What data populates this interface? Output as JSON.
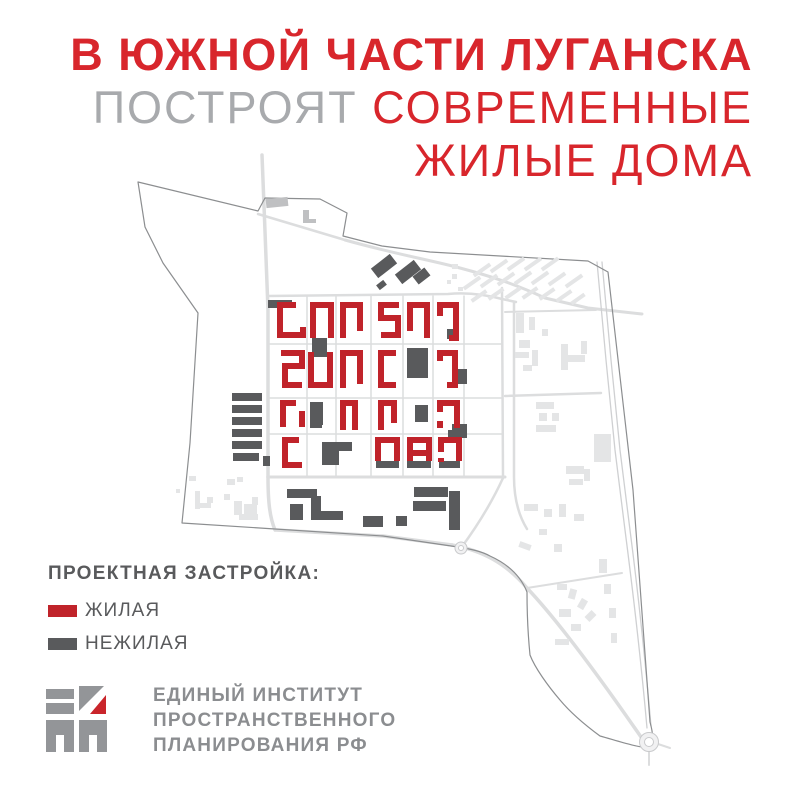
{
  "title": {
    "line1": "В ЮЖНОЙ ЧАСТИ ЛУГАНСКА",
    "line2_gray": "ПОСТРОЯТ",
    "line2_red": "СОВРЕМЕННЫЕ",
    "line3": "ЖИЛЫЕ ДОМА"
  },
  "legend": {
    "heading": "ПРОЕКТНАЯ ЗАСТРОЙКА:",
    "items": [
      {
        "label": "ЖИЛАЯ",
        "color_key": "red-building"
      },
      {
        "label": "НЕЖИЛАЯ",
        "color_key": "dark-building"
      }
    ]
  },
  "logo": {
    "line1": "ЕДИНЫЙ ИНСТИТУТ",
    "line2": "ПРОСТРАНСТВЕННОГО",
    "line3": "ПЛАНИРОВАНИЯ РФ"
  },
  "colors": {
    "title_red": "#d8262c",
    "title_gray": "#a8aaad",
    "text_gray": "#595a5c",
    "logo_gray": "#8b8d90",
    "logo_mark_gray": "#939598",
    "logo_mark_red": "#c9252b",
    "red_building": "#c0232a",
    "dark_building": "#595a5c",
    "medium_building": "#bfc0c2",
    "light_building": "#e4e5e6",
    "road": "#dcddde",
    "rail": "#cfd0d2",
    "boundary": "#8c8e90",
    "roundabout_fill": "#f1f1f2",
    "roundabout_stroke": "#c9cacc"
  },
  "map": {
    "boundary": "M138,182 L258,211 L265,198 L320,199 L347,213 L343,236 L382,246 L430,252 L588,261 L608,272 L633,490 L650,722 C653,733 654,741 650,748 C635,747 618,741 600,736 C585,725 570,712 560,700 C548,686 535,668 530,655 C528,635 527,610 527,592 C521,577 510,565 490,556 C481,551 470,549 458,547 L383,536 L275,529 L182,523 L190,443 L198,313 L163,263 L145,227 Z",
    "roads": [
      {
        "d": "M262,155 C264,210 266,250 268,310 L268,477",
        "w": 3.5
      },
      {
        "d": "M268,477 C268,503 270,518 275,530",
        "w": 3.5
      },
      {
        "d": "M258,214 L345,240",
        "w": 2.5
      },
      {
        "d": "M345,240 C395,254 430,260 460,268 C490,276 515,284 545,298 L588,308 L642,314",
        "w": 3
      },
      {
        "d": "M268,296 L448,294 C468,292 487,295 502,299 L516,302",
        "w": 2.5
      },
      {
        "d": "M268,477 L505,477",
        "w": 3
      },
      {
        "d": "M502,288 L503,477",
        "w": 2.5
      },
      {
        "d": "M514,302 L514,477 C514,500 519,516 527,529",
        "w": 2.5
      },
      {
        "d": "M505,396 L601,393",
        "w": 2.5
      },
      {
        "d": "M505,312 L596,310",
        "w": 2
      },
      {
        "d": "M307,296 L307,477",
        "w": 1.5
      },
      {
        "d": "M336,296 L336,477",
        "w": 1.5
      },
      {
        "d": "M371,296 L371,477",
        "w": 1.5
      },
      {
        "d": "M403,296 L403,477",
        "w": 1.5
      },
      {
        "d": "M433,296 L433,477",
        "w": 1.5
      },
      {
        "d": "M464,296 L464,477",
        "w": 1.5
      },
      {
        "d": "M268,344 L502,344",
        "w": 1.5
      },
      {
        "d": "M268,398 L502,398",
        "w": 1.5
      },
      {
        "d": "M268,434 L502,434",
        "w": 1.5
      },
      {
        "d": "M276,530 L383,536 L452,545",
        "w": 3.5
      },
      {
        "d": "M452,545 C480,550 505,562 527,588 C562,625 605,685 641,737",
        "w": 3.5
      },
      {
        "d": "M461,548 C478,525 492,502 503,478",
        "w": 2.5
      },
      {
        "d": "M527,588 L622,573",
        "w": 2
      },
      {
        "d": "M649,751 L649,765",
        "w": 2
      },
      {
        "d": "M658,744 L670,748",
        "w": 2
      },
      {
        "d": "M597,262 L606,360 L615,450 L625,530 C633,592 641,660 647,728",
        "w": 1.3,
        "rail": true
      },
      {
        "d": "M602,262 L611,360 L620,450 L630,530 C638,592 645,658 651,726",
        "w": 1.3,
        "rail": true
      }
    ],
    "light_buildings": [
      [
        472,
        268,
        20,
        4,
        -35
      ],
      [
        489,
        264,
        20,
        4,
        -35
      ],
      [
        506,
        262,
        20,
        4,
        -35
      ],
      [
        523,
        262,
        20,
        4,
        -35
      ],
      [
        540,
        262,
        20,
        4,
        -35
      ],
      [
        462,
        281,
        20,
        4,
        -35
      ],
      [
        479,
        279,
        20,
        4,
        -35
      ],
      [
        496,
        277,
        20,
        4,
        -35
      ],
      [
        513,
        276,
        20,
        4,
        -35
      ],
      [
        530,
        276,
        20,
        4,
        -35
      ],
      [
        547,
        277,
        20,
        4,
        -35
      ],
      [
        564,
        279,
        20,
        4,
        -35
      ],
      [
        470,
        294,
        18,
        4,
        -35
      ],
      [
        487,
        292,
        18,
        4,
        -35
      ],
      [
        504,
        291,
        18,
        4,
        -35
      ],
      [
        521,
        291,
        18,
        4,
        -35
      ],
      [
        538,
        292,
        18,
        4,
        -35
      ],
      [
        555,
        294,
        18,
        4,
        -35
      ],
      [
        570,
        297,
        16,
        4,
        -35
      ],
      [
        452,
        264,
        6,
        5
      ],
      [
        452,
        274,
        5,
        5
      ],
      [
        458,
        287,
        5,
        4
      ],
      [
        447,
        280,
        4,
        4
      ],
      [
        516,
        313,
        8,
        20
      ],
      [
        529,
        317,
        6,
        13
      ],
      [
        519,
        340,
        11,
        8
      ],
      [
        515,
        352,
        14,
        6
      ],
      [
        532,
        350,
        6,
        16
      ],
      [
        523,
        365,
        9,
        6
      ],
      [
        542,
        329,
        6,
        7
      ],
      [
        561,
        344,
        7,
        26
      ],
      [
        561,
        355,
        24,
        7
      ],
      [
        581,
        341,
        6,
        13
      ],
      [
        536,
        402,
        18,
        7
      ],
      [
        539,
        413,
        8,
        8
      ],
      [
        552,
        413,
        7,
        8
      ],
      [
        536,
        425,
        20,
        7
      ],
      [
        594,
        434,
        17,
        28
      ],
      [
        566,
        466,
        18,
        8
      ],
      [
        569,
        479,
        14,
        6
      ],
      [
        584,
        469,
        6,
        12
      ],
      [
        524,
        504,
        14,
        7
      ],
      [
        544,
        509,
        8,
        8
      ],
      [
        559,
        504,
        7,
        13
      ],
      [
        574,
        514,
        10,
        7
      ],
      [
        539,
        529,
        8,
        6
      ],
      [
        519,
        543,
        12,
        6,
        20
      ],
      [
        554,
        544,
        8,
        8
      ],
      [
        557,
        584,
        10,
        6
      ],
      [
        569,
        589,
        7,
        10,
        15
      ],
      [
        579,
        599,
        7,
        10,
        30
      ],
      [
        587,
        611,
        7,
        10,
        45
      ],
      [
        559,
        609,
        12,
        8
      ],
      [
        571,
        624,
        10,
        7
      ],
      [
        555,
        639,
        14,
        6
      ],
      [
        599,
        559,
        8,
        14
      ],
      [
        604,
        584,
        7,
        10
      ],
      [
        609,
        608,
        7,
        10
      ],
      [
        611,
        633,
        6,
        10
      ],
      [
        189,
        476,
        7,
        5
      ],
      [
        176,
        489,
        4,
        4
      ],
      [
        195,
        491,
        5,
        18
      ],
      [
        195,
        503,
        16,
        5
      ],
      [
        207,
        497,
        6,
        6
      ],
      [
        227,
        479,
        8,
        6
      ],
      [
        237,
        477,
        6,
        5
      ],
      [
        224,
        494,
        6,
        6
      ],
      [
        234,
        501,
        8,
        14
      ],
      [
        244,
        504,
        13,
        10
      ],
      [
        239,
        514,
        19,
        6
      ],
      [
        252,
        497,
        6,
        8
      ]
    ],
    "medium_buildings": [
      [
        266,
        198,
        22,
        9,
        -6
      ],
      [
        303,
        210,
        6,
        13
      ],
      [
        303,
        219,
        13,
        4
      ]
    ],
    "dark_buildings": [
      [
        232,
        393,
        30,
        8
      ],
      [
        232,
        405,
        30,
        8
      ],
      [
        232,
        417,
        30,
        8
      ],
      [
        232,
        429,
        30,
        8
      ],
      [
        232,
        441,
        30,
        8
      ],
      [
        233,
        453,
        26,
        8
      ],
      [
        263,
        456,
        7,
        10
      ],
      [
        372,
        260,
        24,
        12,
        -38
      ],
      [
        396,
        266,
        24,
        12,
        -38
      ],
      [
        414,
        271,
        15,
        10,
        -38
      ],
      [
        377,
        282,
        9,
        6,
        -38
      ],
      [
        268,
        300,
        24,
        8
      ],
      [
        312,
        338,
        15,
        19
      ],
      [
        407,
        348,
        21,
        30
      ],
      [
        447,
        329,
        10,
        10
      ],
      [
        452,
        369,
        15,
        15
      ],
      [
        310,
        402,
        13,
        23
      ],
      [
        310,
        417,
        12,
        11
      ],
      [
        415,
        405,
        13,
        17
      ],
      [
        452,
        424,
        15,
        14
      ],
      [
        322,
        442,
        30,
        9
      ],
      [
        322,
        449,
        17,
        16
      ],
      [
        376,
        461,
        23,
        7
      ],
      [
        407,
        461,
        24,
        7
      ],
      [
        439,
        461,
        21,
        7
      ],
      [
        448,
        430,
        14,
        9
      ],
      [
        287,
        489,
        30,
        9
      ],
      [
        290,
        504,
        13,
        16
      ],
      [
        311,
        496,
        10,
        24
      ],
      [
        319,
        511,
        24,
        9
      ],
      [
        414,
        487,
        34,
        10
      ],
      [
        413,
        501,
        33,
        10
      ],
      [
        449,
        491,
        11,
        39
      ],
      [
        363,
        516,
        20,
        11
      ],
      [
        396,
        516,
        11,
        10
      ]
    ],
    "red_buildings": [
      "M296,305 L280,305 L280,335 L303,335 L303,327",
      "M313,338 L313,305 L331,305 L331,338",
      "M343,338 L343,305 L360,305 L360,331",
      "M399,305 L381,305 L381,318 L398,318 L398,335 L381,335",
      "M410,331 L410,305 L427,305 L427,338",
      "M440,316 L440,305 L456,305 L456,338 L449,338",
      "M281,353 L302,353 L302,366 L285,366 L285,385 L302,385",
      "M311,352 L311,385 L330,385 L330,352",
      "M343,388 L343,353 L360,353 L360,384",
      "M396,353 L381,353 L381,385 L396,385",
      "M440,361 L440,353 L455,353 L455,385 L447,385",
      "M283,427 L283,403 L296,403 M302,411 L302,427",
      "M343,430 L343,403 L355,403 L355,430",
      "M381,430 L381,403 L394,403 L394,423",
      "M440,412 L440,403 L457,403 L457,428 M440,421 L440,428",
      "M299,440 L285,440 L285,465 L302,465",
      "M378,461 L378,440 L397,440 L397,461",
      "M410,461 L410,440 L429,440 L429,461 M411,453 L428,453",
      "M441,452 L441,440 L459,440 L459,461 M441,458 L441,462"
    ],
    "roundabouts": [
      [
        649,
        742,
        9.5,
        4.5
      ],
      [
        461,
        548,
        6,
        2.5
      ]
    ]
  }
}
